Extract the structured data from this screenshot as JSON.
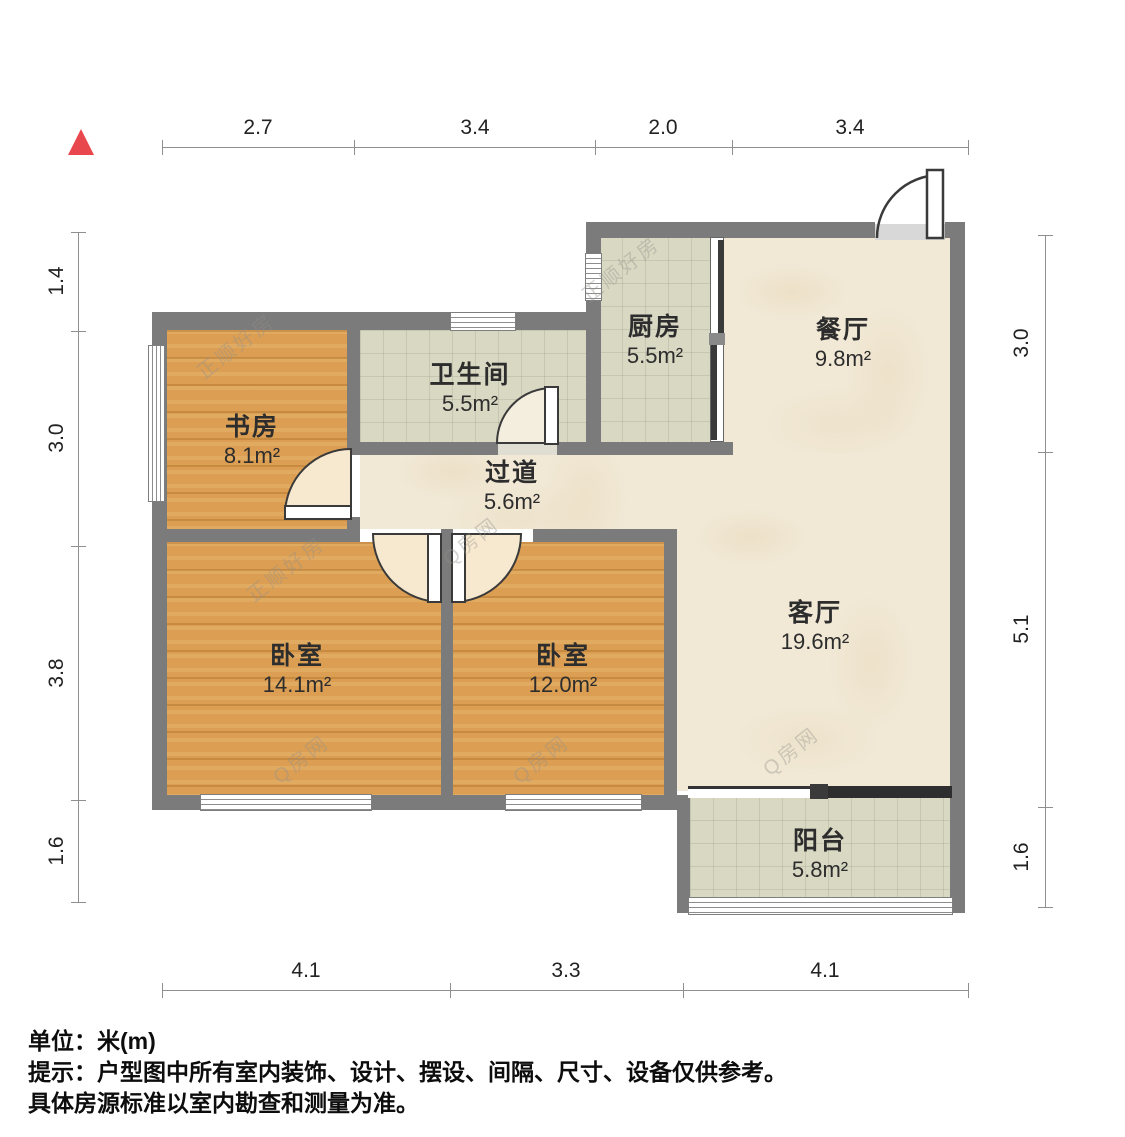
{
  "plan_title": "户型图",
  "rooms": [
    {
      "name": "书房",
      "area": "8.1m²"
    },
    {
      "name": "卫生间",
      "area": "5.5m²"
    },
    {
      "name": "厨房",
      "area": "5.5m²"
    },
    {
      "name": "餐厅",
      "area": "9.8m²"
    },
    {
      "name": "过道",
      "area": "5.6m²"
    },
    {
      "name": "卧室",
      "area": "14.1m²"
    },
    {
      "name": "卧室",
      "area": "12.0m²"
    },
    {
      "name": "客厅",
      "area": "19.6m²"
    },
    {
      "name": "阳台",
      "area": "5.8m²"
    }
  ],
  "dimensions": {
    "top": [
      "2.7",
      "3.4",
      "2.0",
      "3.4"
    ],
    "bottom": [
      "4.1",
      "3.3",
      "4.1"
    ],
    "left": [
      "1.4",
      "3.0",
      "3.8",
      "1.6"
    ],
    "right": [
      "3.0",
      "5.1",
      "1.6"
    ]
  },
  "footer": {
    "line1": "单位：米(m)",
    "line2": "提示：户型图中所有室内装饰、设计、摆设、间隔、尺寸、设备仅供参考。",
    "line3": "具体房源标准以室内勘查和测量为准。"
  },
  "watermarks": [
    "正顺好房",
    "Q房网"
  ],
  "colors": {
    "wall": "#7b7b7b",
    "wood": "#db9e53",
    "tile": "#d9d8c3",
    "cream": "#f1e9d6",
    "north_arrow": "#e8484d"
  }
}
